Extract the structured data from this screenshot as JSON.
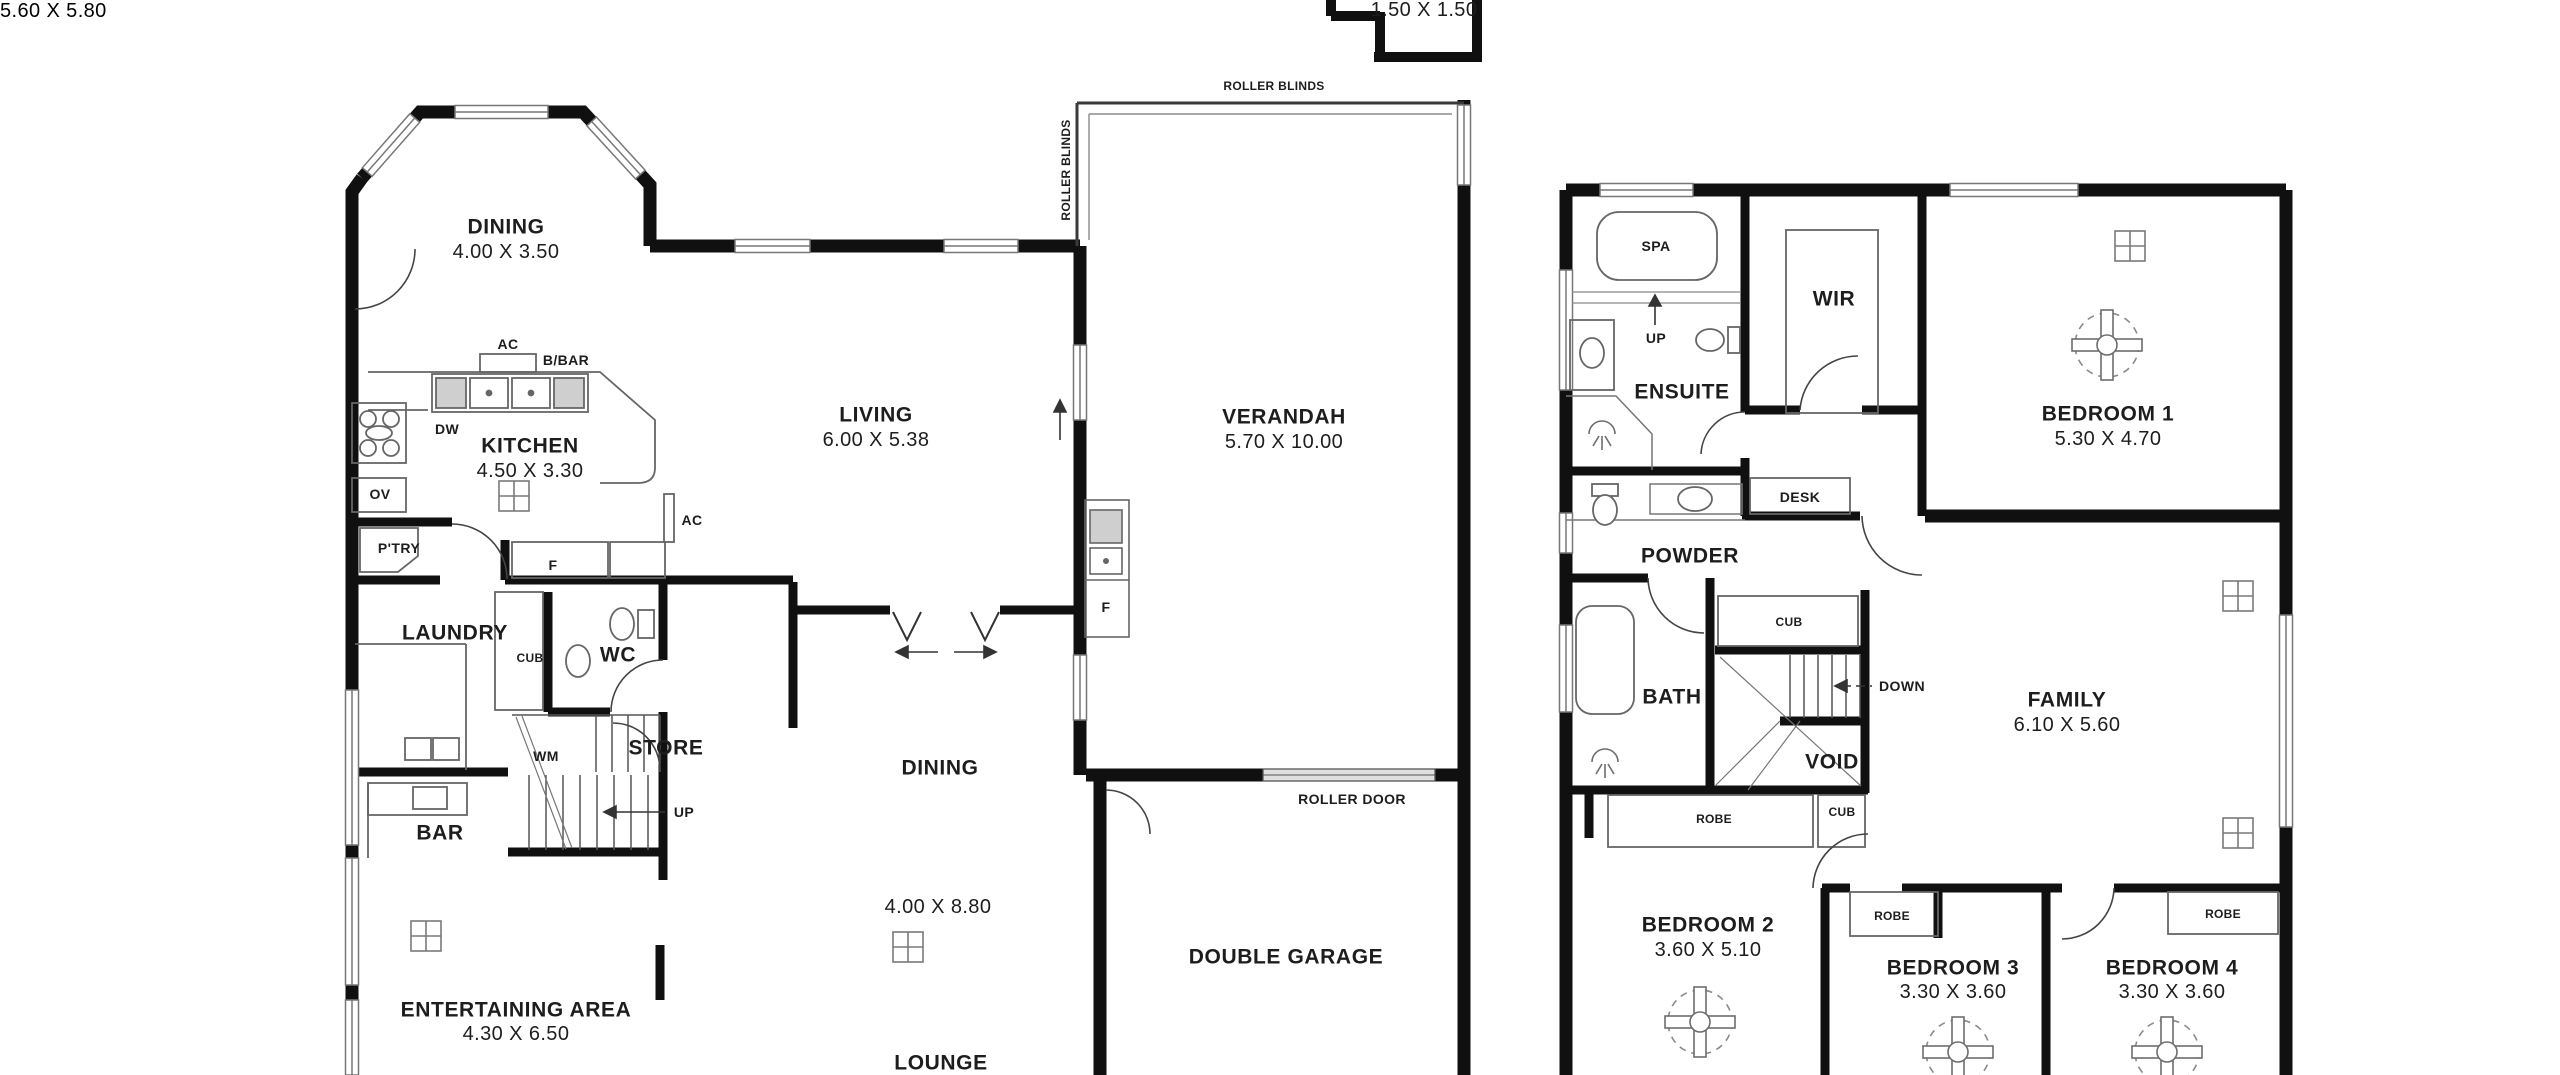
{
  "floorplan": {
    "colors": {
      "background": "#ffffff",
      "wall": "#101010",
      "thin_line": "#6f6f6f",
      "text": "#1d1d1d",
      "roller_door_fill": "#e0e0e0"
    },
    "ground_floor": {
      "rooms": [
        {
          "name": "DINING",
          "dims": "4.00 X 3.50"
        },
        {
          "name": "KITCHEN",
          "dims": "4.50 X 3.30"
        },
        {
          "name": "LIVING",
          "dims": "6.00 X 5.38"
        },
        {
          "name": "VERANDAH",
          "dims": "5.70 X 10.00"
        },
        {
          "name": "LAUNDRY"
        },
        {
          "name": "WC"
        },
        {
          "name": "STORE"
        },
        {
          "name": "BAR"
        },
        {
          "name": "DINING",
          "dims": "4.00 X 8.80"
        },
        {
          "name": "LOUNGE"
        },
        {
          "name": "ENTERTAINING AREA",
          "dims": "4.30 X 6.50"
        },
        {
          "name": "DOUBLE GARAGE",
          "dims": "5.60 X 5.80"
        }
      ],
      "annotations": {
        "storage_dims": "1.50 X 1.50",
        "roller_blinds": "ROLLER BLINDS",
        "roller_door": "ROLLER DOOR",
        "ac": "AC",
        "breakfast_bar": "B/BAR",
        "dishwasher": "DW",
        "oven": "OV",
        "pantry": "P'TRY",
        "fridge": "F",
        "cupboard": "CUB",
        "washing_machine": "WM",
        "up": "UP"
      }
    },
    "upper_floor": {
      "rooms": [
        {
          "name": "ENSUITE"
        },
        {
          "name": "WIR"
        },
        {
          "name": "BEDROOM 1",
          "dims": "5.30 X 4.70"
        },
        {
          "name": "POWDER"
        },
        {
          "name": "BATH"
        },
        {
          "name": "VOID"
        },
        {
          "name": "FAMILY",
          "dims": "6.10 X 5.60"
        },
        {
          "name": "BEDROOM 2",
          "dims": "3.60 X 5.10"
        },
        {
          "name": "BEDROOM 3",
          "dims": "3.30 X 3.60"
        },
        {
          "name": "BEDROOM 4",
          "dims": "3.30 X 3.60"
        }
      ],
      "annotations": {
        "spa": "SPA",
        "up": "UP",
        "desk": "DESK",
        "cupboard": "CUB",
        "down": "DOWN",
        "robe": "ROBE"
      }
    }
  }
}
